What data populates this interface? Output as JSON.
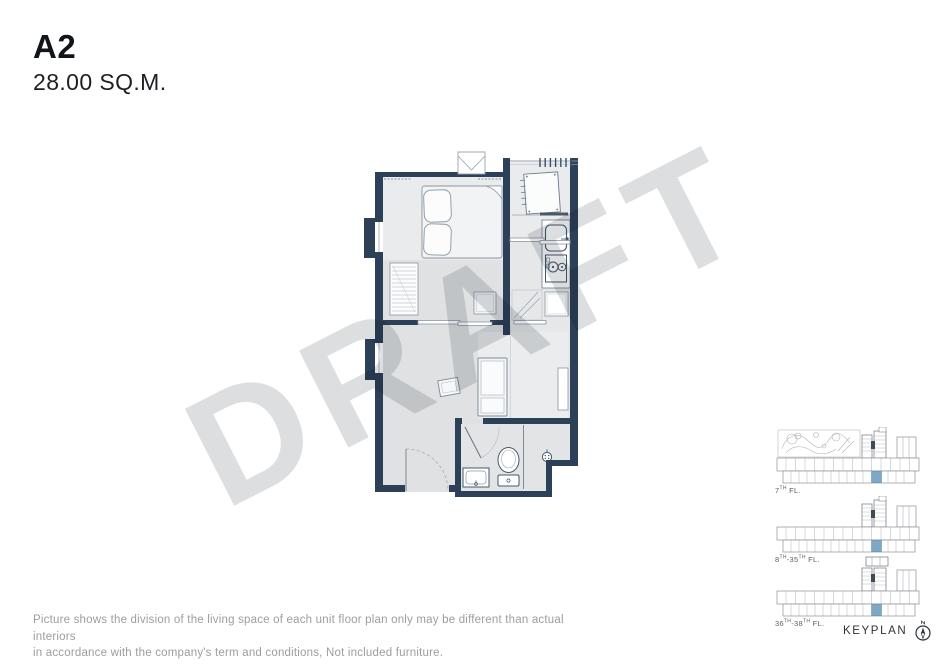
{
  "header": {
    "unit_name": "A2",
    "unit_area": "28.00 SQ.M."
  },
  "watermark": {
    "text": "DRAFT"
  },
  "keyplan": {
    "heading": "KEYPLAN",
    "floors": [
      {
        "p1": "7",
        "sup1": "TH",
        "p2": " FL.",
        "sup2": "",
        "p3": ""
      },
      {
        "p1": "8",
        "sup1": "TH",
        "p2": "-35",
        "sup2": "TH",
        "p3": " FL."
      },
      {
        "p1": "36",
        "sup1": "TH",
        "p2": "-38",
        "sup2": "TH",
        "p3": " FL."
      }
    ]
  },
  "disclaimer": {
    "line1": "Picture shows the division of the living space of each unit floor plan only may be different than actual interiors",
    "line2": "in accordance with the company's term and conditions, Not included furniture."
  },
  "colors": {
    "wall": "#2c4058",
    "floor": "#e0e2e4",
    "floor_light": "#eaecee",
    "keyplan_highlight": "#7da8c6",
    "watermark": "#dcdee0"
  }
}
